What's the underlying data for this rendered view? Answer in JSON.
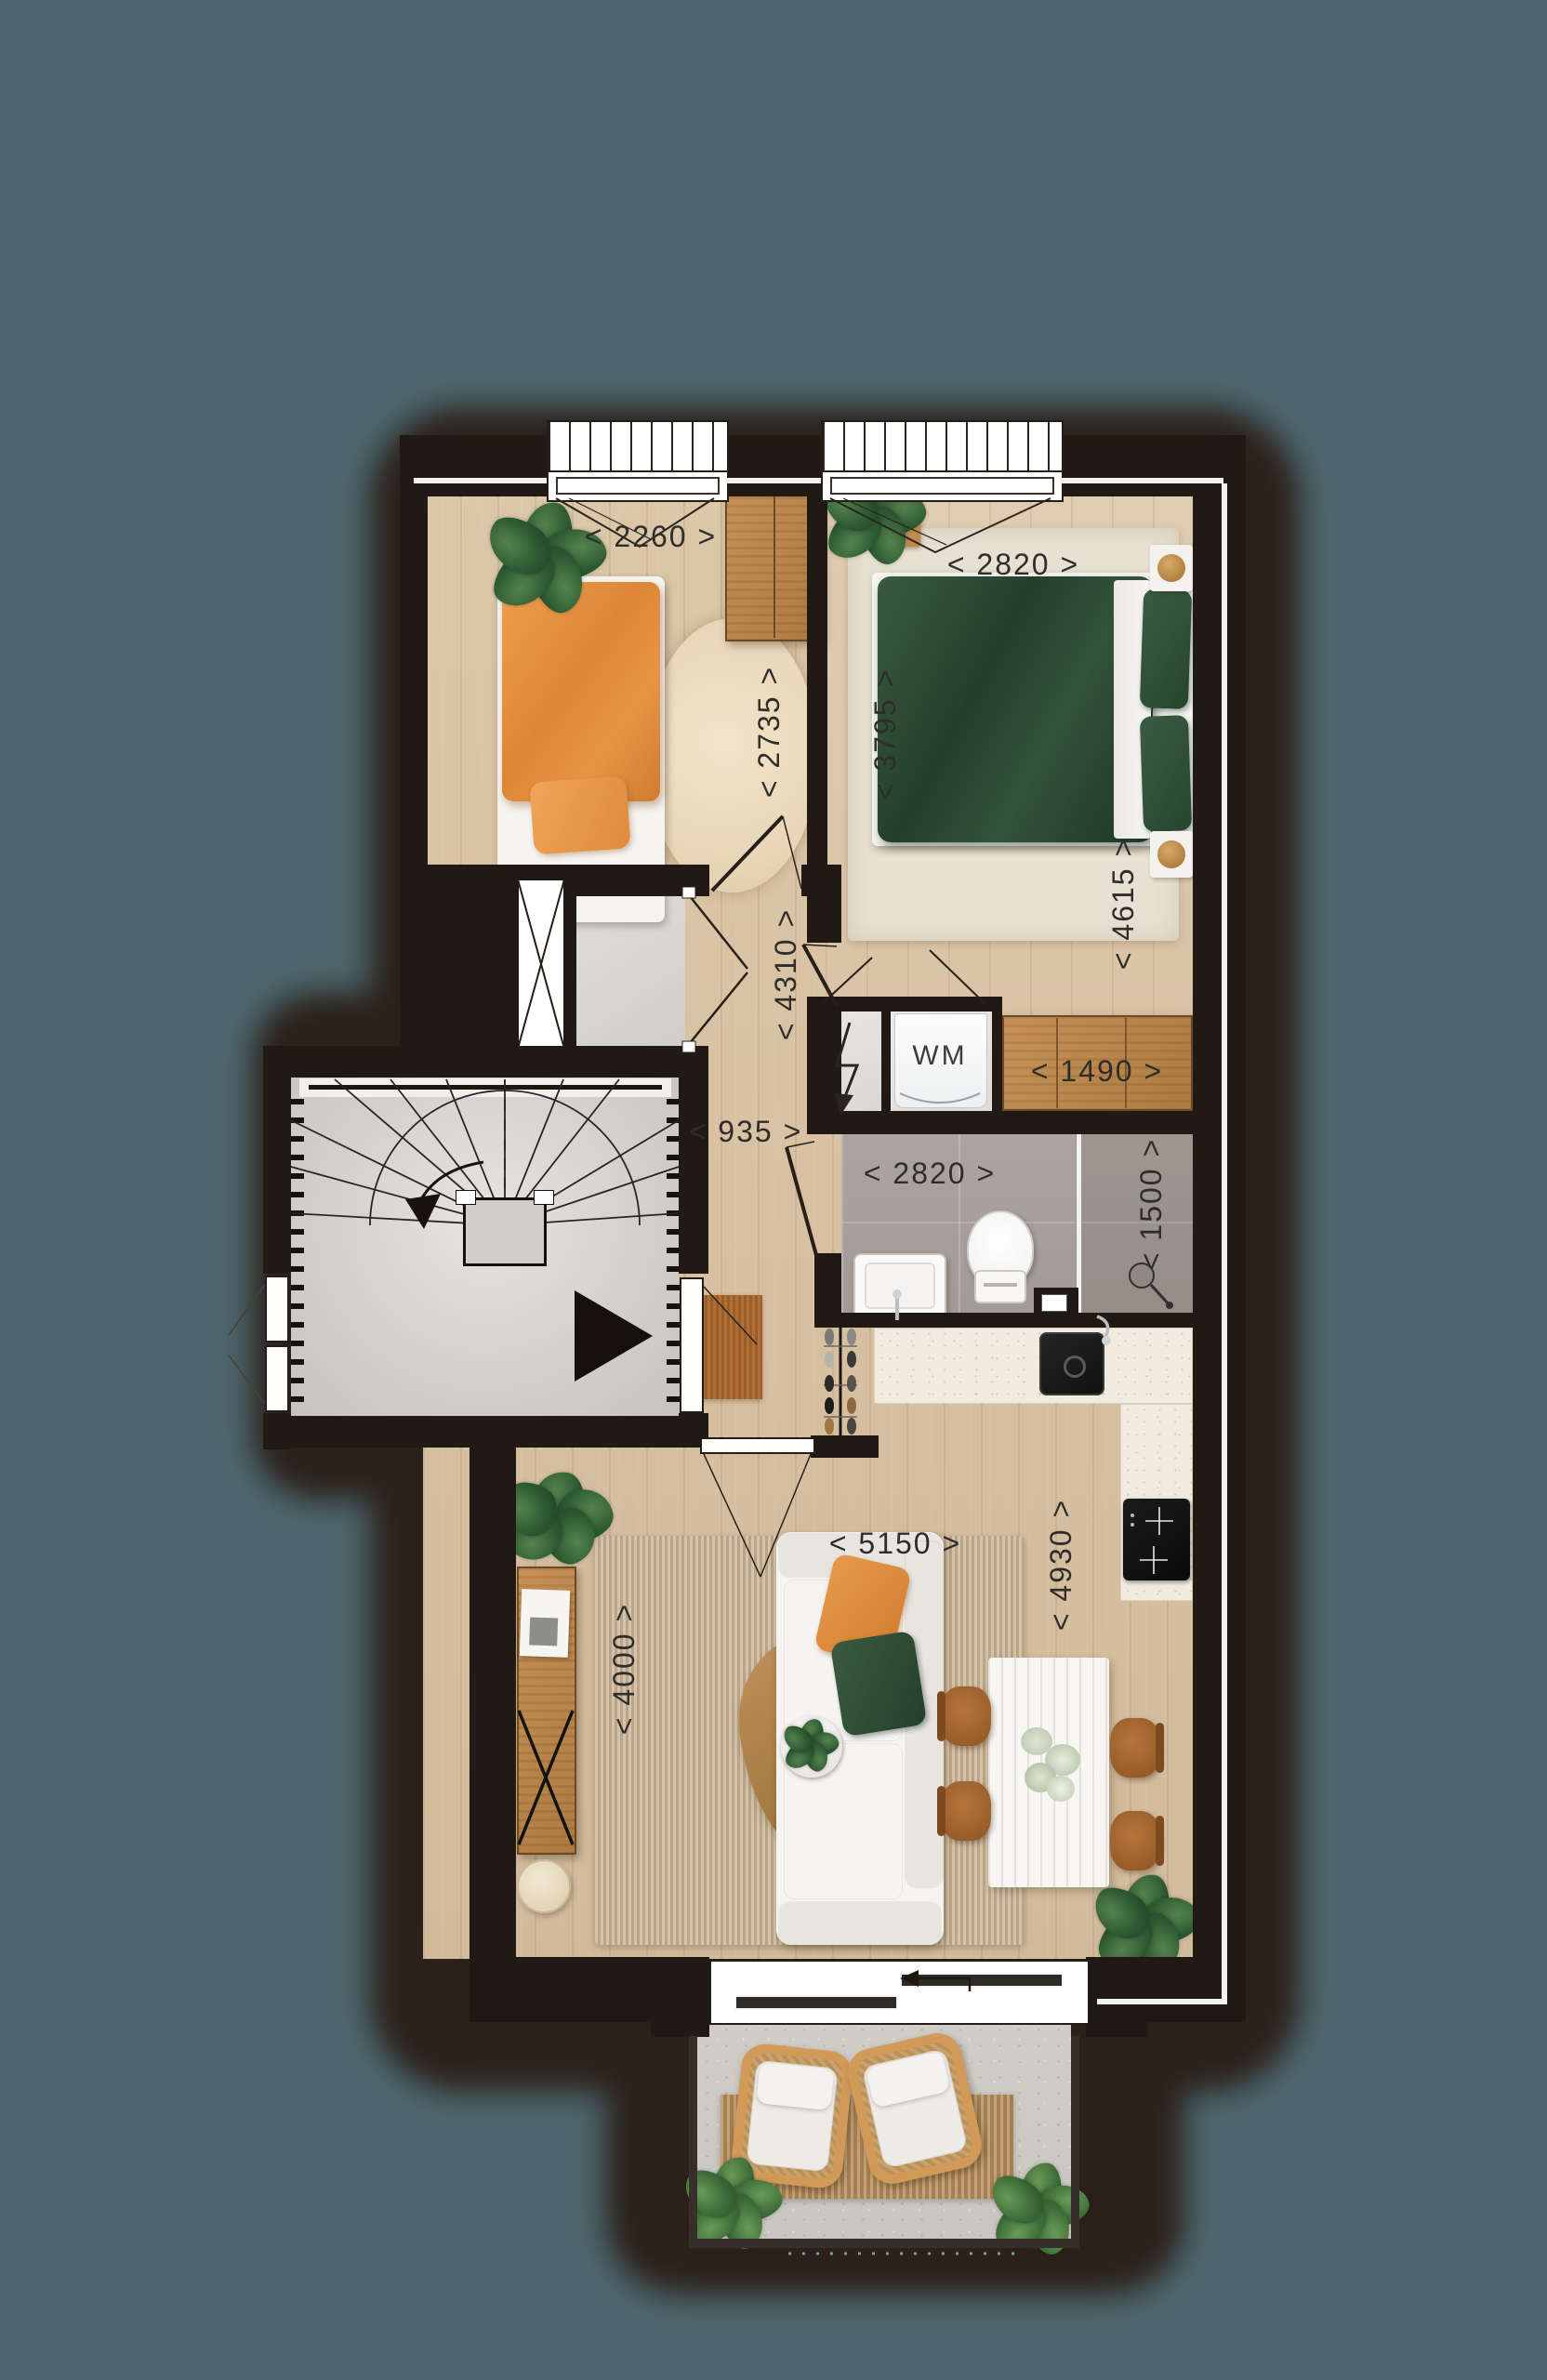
{
  "dimensions_mm": {
    "bedroom1_width": "< 2260 >",
    "bedroom1_depth": "< 2735 >",
    "bedroom2_width": "< 2820 >",
    "bedroom2_depth": "< 3795 >",
    "bedroom2_length": "< 4615 >",
    "hall_length": "< 4310 >",
    "hall_width": "< 935 >",
    "bedroom2_closet_width": "< 1490 >",
    "bathroom_width": "< 2820 >",
    "bathroom_depth": "< 1500 >",
    "living_room_width": "< 5150 >",
    "living_room_depth": "< 4930 >",
    "living_room_west_depth": "< 4000 >"
  },
  "appliances": {
    "washing_machine_label": "WM"
  },
  "icons": {
    "entry_marker": "triangle-right-icon",
    "stair_direction": "curved-arrow-down-icon",
    "sliding_door_direction": "arrow-left-icon",
    "electric_meter": "lightning-arrow-icon"
  },
  "colors": {
    "background": "#4d666d",
    "wall": "#211a14",
    "shadow_blob": "#2b211a",
    "wood_floor": "#d9c3a6",
    "bathroom_tile": "#aaa39d",
    "stair_floor": "#d9d7d5",
    "terrace_floor": "#cdcac4",
    "kitchen_counter": "#f0eadf",
    "duvet_green": "#2e4a35",
    "duvet_orange": "#e08a3e",
    "furniture_wood": "#c08d55",
    "dashed_line": "#6fa0ab"
  }
}
